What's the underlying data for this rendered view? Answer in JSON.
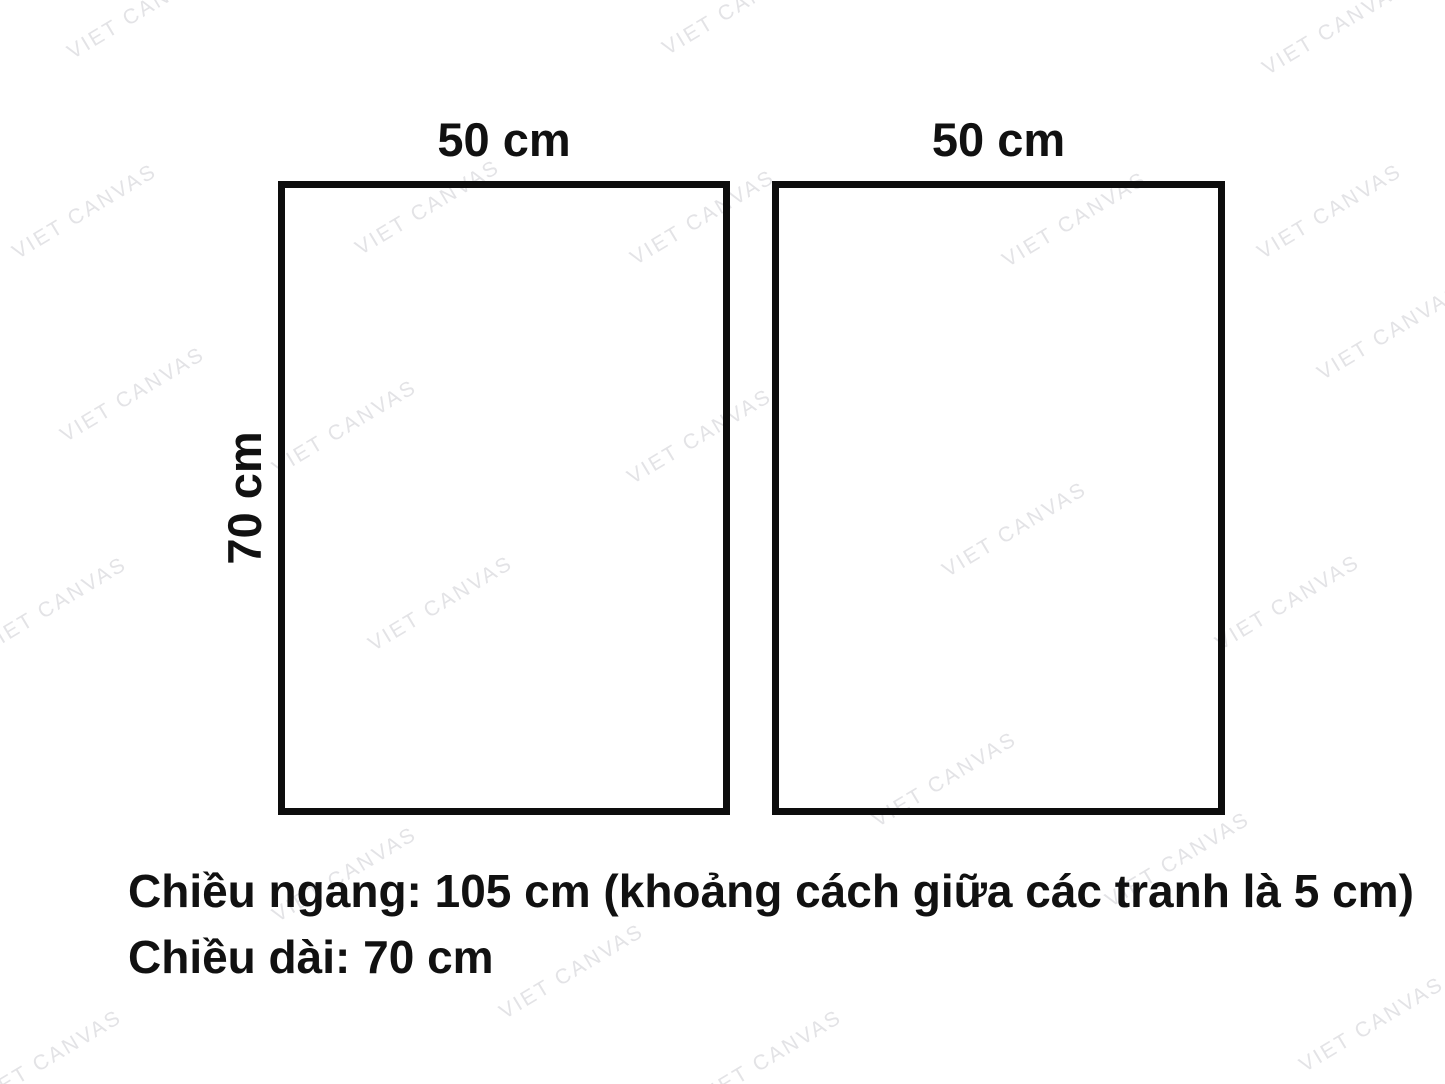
{
  "panels": {
    "left": {
      "width_label": "50 cm",
      "height_label": "70 cm"
    },
    "right": {
      "width_label": "50 cm"
    }
  },
  "caption": {
    "line1": "Chiều ngang: 105 cm (khoảng cách giữa các tranh là 5 cm)",
    "line2": "Chiều dài: 70 cm"
  },
  "watermark": {
    "text": "VIET CANVAS",
    "color": "#e3e3e6",
    "angle_deg": -31,
    "positions": [
      [
        140,
        12
      ],
      [
        735,
        8
      ],
      [
        1335,
        28
      ],
      [
        85,
        212
      ],
      [
        428,
        208
      ],
      [
        703,
        218
      ],
      [
        1075,
        220
      ],
      [
        1330,
        212
      ],
      [
        133,
        395
      ],
      [
        345,
        428
      ],
      [
        700,
        437
      ],
      [
        1390,
        333
      ],
      [
        55,
        605
      ],
      [
        441,
        604
      ],
      [
        1015,
        530
      ],
      [
        1288,
        603
      ],
      [
        345,
        875
      ],
      [
        945,
        780
      ],
      [
        1178,
        860
      ],
      [
        50,
        1058
      ],
      [
        572,
        972
      ],
      [
        770,
        1058
      ],
      [
        1372,
        1025
      ]
    ]
  },
  "colors": {
    "background": "#ffffff",
    "outline": "#0d0d0d",
    "text": "#111111"
  }
}
